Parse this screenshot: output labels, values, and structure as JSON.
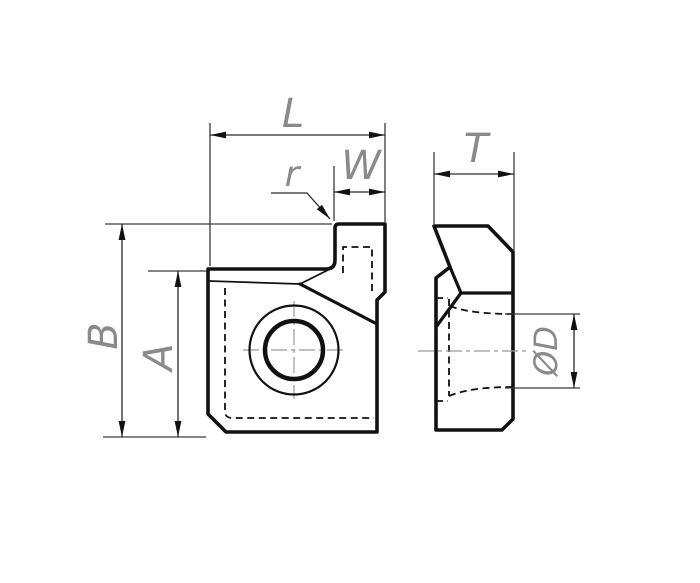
{
  "drawing_type": "technical-drawing-cutting-insert-two-views",
  "labels": {
    "L": "L",
    "W": "W",
    "r": "r",
    "B": "B",
    "A": "A",
    "T": "T",
    "OD": "ØD"
  },
  "palette": {
    "background": "#ffffff",
    "outline": "#111111",
    "thin_lines": "#3a3a3a",
    "dimension_labels": "#8a8a8a",
    "centerlines": "#9a9a9a"
  }
}
